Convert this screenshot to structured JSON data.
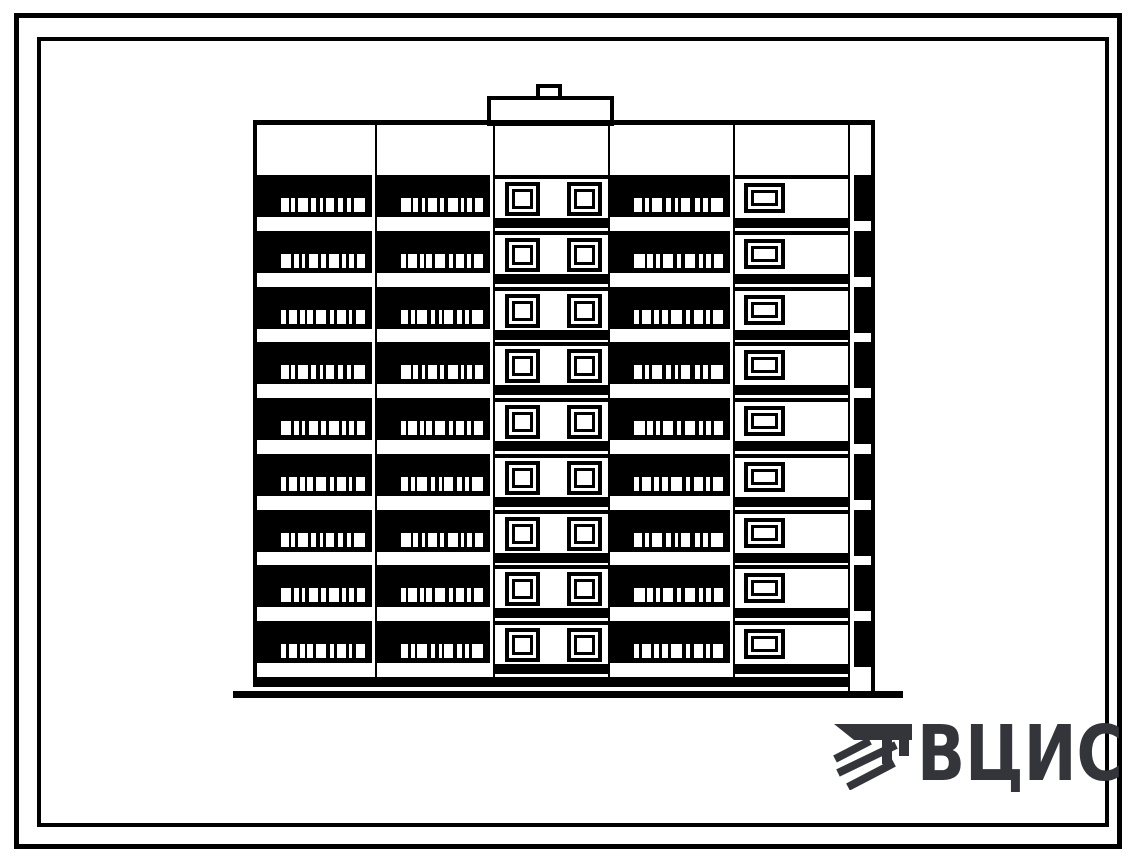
{
  "logo": {
    "text": "ВЦИС",
    "color": "#34353a",
    "icon": "construction-emblem-icon"
  },
  "drawing": {
    "subject": "nine-storey panel apartment building — front elevation",
    "paper": "#ffffff",
    "ink": "#000000",
    "floors": 9,
    "sections": [
      {
        "id": "balcony-left",
        "type": "balcony"
      },
      {
        "id": "balcony-2",
        "type": "balcony"
      },
      {
        "id": "stairwell",
        "type": "stairwell",
        "windows_per_floor": 2
      },
      {
        "id": "balcony-3",
        "type": "balcony"
      },
      {
        "id": "wall",
        "type": "wall-window",
        "windows_per_floor": 1
      },
      {
        "id": "end-wall",
        "type": "end-strip"
      }
    ],
    "roof": {
      "penthouse": true,
      "chimney": true
    },
    "balcony_dash_patterns": [
      [
        [
          0,
          9
        ],
        [
          12,
          5
        ],
        [
          20,
          12
        ],
        [
          36,
          6
        ],
        [
          46,
          4
        ],
        [
          53,
          10
        ],
        [
          68,
          6
        ],
        [
          78,
          5
        ],
        [
          87,
          13
        ]
      ],
      [
        [
          0,
          12
        ],
        [
          15,
          6
        ],
        [
          25,
          4
        ],
        [
          33,
          11
        ],
        [
          48,
          5
        ],
        [
          57,
          12
        ],
        [
          73,
          4
        ],
        [
          81,
          6
        ],
        [
          90,
          10
        ]
      ],
      [
        [
          0,
          6
        ],
        [
          9,
          10
        ],
        [
          23,
          5
        ],
        [
          31,
          7
        ],
        [
          42,
          12
        ],
        [
          58,
          5
        ],
        [
          67,
          10
        ],
        [
          81,
          4
        ],
        [
          89,
          11
        ]
      ]
    ]
  }
}
